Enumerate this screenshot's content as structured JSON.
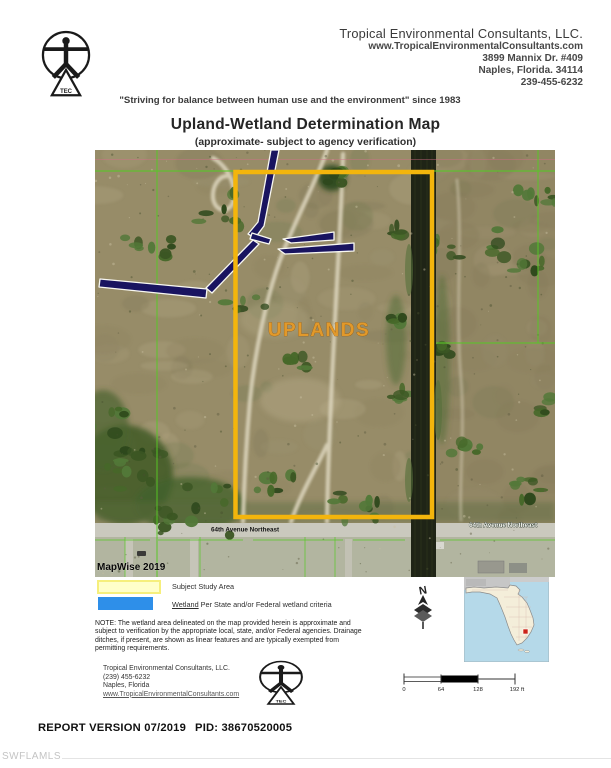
{
  "header": {
    "company": "Tropical Environmental Consultants, LLC.",
    "website": "www.TropicalEnvironmentalConsultants.com",
    "address1": "3899 Mannix Dr. #409",
    "address2": "Naples, Florida. 34114",
    "phone": "239-455-6232",
    "tagline": "\"Striving for balance between human use and the environment\" since 1983",
    "logo_acronym": "TEC"
  },
  "title": "Upland-Wetland Determination Map",
  "subtitle": "(approximate- subject to agency verification)",
  "map": {
    "uplands_label": "UPLANDS",
    "road_left": "64th Avenue Northeast",
    "road_right": "64th Avenue Northeast",
    "credit": "MapWise 2019"
  },
  "legend": {
    "study_area": "Subject Study Area",
    "wetland_word": "Wetland",
    "wetland_rest": " Per State and/or Federal wetland criteria",
    "north": "N"
  },
  "note": {
    "lines": [
      "NOTE: The wetland area delineated on the map provided herein is approximate and",
      "subject to verification by the appropriate local, state, and/or Federal agencies. Drainage",
      "ditches, if present, are shown as linear features and are typically exempted from",
      "permitting requirements."
    ]
  },
  "contact": {
    "company": "Tropical Environmental Consultants, LLC.",
    "phone": "(239) 455-6232",
    "city": "Naples, Florida",
    "website": "www.TropicalEnvironmentalConsultants.com"
  },
  "scale": {
    "t0": "0",
    "t1": "64",
    "t2": "128",
    "t3": "192 ft"
  },
  "footer": {
    "report_version": "REPORT VERSION 07/2019",
    "pid": "PID: 38670520005"
  },
  "watermark": "SWFLAMLS",
  "colors": {
    "study_boundary": "#f3b50c",
    "wetland_fill": "#191460",
    "parcel_line_green": "#58c926",
    "study_swatch": "#ffffca",
    "wetland_swatch": "#2e8fe9",
    "uplands_text": "#e1992b",
    "canal": "#1f2416",
    "terrain": "#978c68",
    "road": "#cac9be",
    "florida_land": "#f4eeda",
    "florida_water": "#b5d9e9",
    "site_marker_red": "#cc2418"
  }
}
